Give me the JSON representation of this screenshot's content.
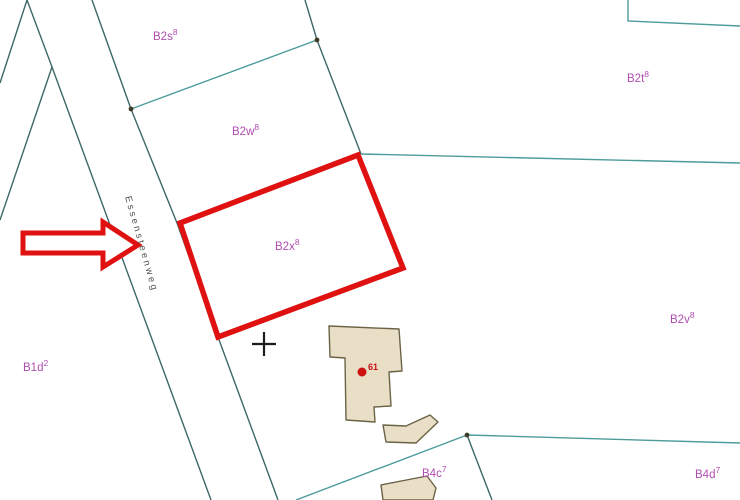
{
  "map": {
    "width": 740,
    "height": 500,
    "colors": {
      "background": "#FFFFFF",
      "line_teal": "#4E9B9B",
      "line_dark": "#3E6868",
      "label_purple": "#B04DB0",
      "road_text": "#50504A",
      "highlight_red": "#DF1111",
      "building_fill": "#E9DFC7",
      "building_stroke": "#6A6345",
      "marker_red": "#CC1111",
      "cross_black": "#1C1C1C",
      "vertex_dot": "#3C3C28"
    },
    "lines": [
      {
        "name": "parcel-edge-northwest-1",
        "tone": "dark",
        "points": [
          [
            27,
            0
          ],
          [
            0,
            83
          ]
        ]
      },
      {
        "name": "road-left-boundary",
        "tone": "dark",
        "points": [
          [
            27,
            0
          ],
          [
            52,
            67
          ],
          [
            211,
            500
          ]
        ]
      },
      {
        "name": "parcel-edge-northwest-2",
        "tone": "dark",
        "points": [
          [
            52,
            67
          ],
          [
            0,
            220
          ]
        ]
      },
      {
        "name": "road-right-boundary",
        "tone": "dark",
        "points": [
          [
            92,
            0
          ],
          [
            131,
            109
          ],
          [
            177,
            223
          ],
          [
            218,
            337
          ],
          [
            278,
            500
          ]
        ]
      },
      {
        "name": "boundary-b2s-b2w",
        "tone": "teal",
        "points": [
          [
            131,
            109
          ],
          [
            317,
            40
          ]
        ]
      },
      {
        "name": "boundary-b2w-east",
        "tone": "dark",
        "points": [
          [
            305,
            0
          ],
          [
            317,
            40
          ],
          [
            361,
            154
          ]
        ]
      },
      {
        "name": "boundary-b2x-b2t",
        "tone": "teal",
        "points": [
          [
            361,
            154
          ],
          [
            740,
            163
          ]
        ]
      },
      {
        "name": "parcel-corner-northeast",
        "tone": "teal",
        "points": [
          [
            628,
            0
          ],
          [
            628,
            21
          ],
          [
            740,
            26
          ]
        ]
      },
      {
        "name": "boundary-b4c-west",
        "tone": "teal",
        "points": [
          [
            296,
            500
          ],
          [
            467,
            435
          ]
        ]
      },
      {
        "name": "boundary-b4c-b4d",
        "tone": "teal",
        "points": [
          [
            467,
            435
          ],
          [
            740,
            443
          ]
        ]
      },
      {
        "name": "boundary-b4c-south",
        "tone": "dark",
        "points": [
          [
            467,
            435
          ],
          [
            492,
            500
          ]
        ]
      }
    ],
    "vertex_dots": [
      [
        131,
        109
      ],
      [
        317,
        40
      ],
      [
        467,
        435
      ]
    ],
    "buildings": [
      {
        "name": "building-main",
        "points": [
          [
            329,
            326
          ],
          [
            399,
            329
          ],
          [
            402,
            371
          ],
          [
            389,
            372
          ],
          [
            391,
            406
          ],
          [
            374,
            407
          ],
          [
            375,
            422
          ],
          [
            346,
            420
          ],
          [
            345,
            358
          ],
          [
            330,
            357
          ]
        ]
      },
      {
        "name": "building-annex",
        "points": [
          [
            383,
            425
          ],
          [
            406,
            426
          ],
          [
            430,
            415
          ],
          [
            438,
            422
          ],
          [
            416,
            443
          ],
          [
            386,
            442
          ]
        ]
      },
      {
        "name": "building-south",
        "points": [
          [
            381,
            485
          ],
          [
            427,
            476
          ],
          [
            436,
            488
          ],
          [
            433,
            500
          ],
          [
            383,
            500
          ]
        ]
      }
    ],
    "highlight": {
      "name": "highlighted-parcel-outline",
      "stroke_width": 5.5,
      "points": [
        [
          358,
          155
        ],
        [
          403,
          268
        ],
        [
          218,
          337
        ],
        [
          180,
          223
        ]
      ]
    },
    "arrow": {
      "stroke_width": 5,
      "points": [
        [
          23,
          233
        ],
        [
          103,
          233
        ],
        [
          103,
          222
        ],
        [
          138,
          245
        ],
        [
          103,
          267
        ],
        [
          103,
          253
        ],
        [
          23,
          253
        ]
      ]
    },
    "parcel_labels": [
      {
        "id": "b2s",
        "text": "B2s",
        "sup": "8",
        "x": 153,
        "y": 40
      },
      {
        "id": "b2w",
        "text": "B2w",
        "sup": "8",
        "x": 232,
        "y": 135
      },
      {
        "id": "b2x",
        "text": "B2x",
        "sup": "8",
        "x": 275,
        "y": 250
      },
      {
        "id": "b2t",
        "text": "B2t",
        "sup": "8",
        "x": 627,
        "y": 82
      },
      {
        "id": "b2v",
        "text": "B2v",
        "sup": "8",
        "x": 670,
        "y": 323
      },
      {
        "id": "b1d",
        "text": "B1d",
        "sup": "2",
        "x": 23,
        "y": 371
      },
      {
        "id": "b4c",
        "text": "B4c",
        "sup": "7",
        "x": 422,
        "y": 477
      },
      {
        "id": "b4d",
        "text": "B4d",
        "sup": "7",
        "x": 695,
        "y": 478
      }
    ],
    "road_label": {
      "text": "Essensteenweg",
      "x": 125,
      "y": 197,
      "angle": 74,
      "letter_spacing": 2.5,
      "font_size": 9.5
    },
    "cross_marker": {
      "x": 264,
      "y": 344,
      "arm": 12
    },
    "house_marker": {
      "x": 362,
      "y": 372,
      "radius": 4.5,
      "label": "61",
      "label_x": 368,
      "label_y": 370
    }
  }
}
